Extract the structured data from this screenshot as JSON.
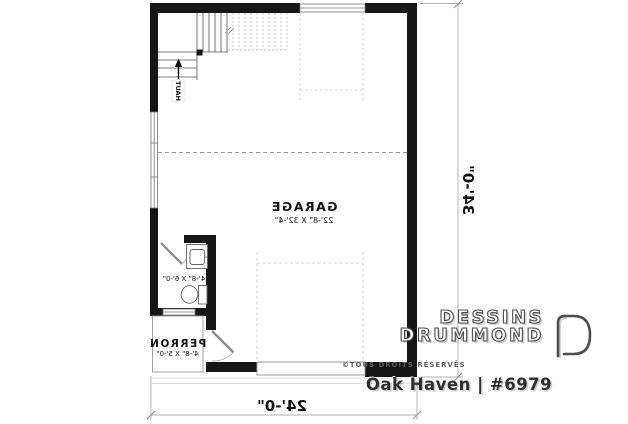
{
  "plan": {
    "rooms": {
      "garage": {
        "name": "GARAGE",
        "dims": "22'-8\" X 32'-4\""
      },
      "bathroom": {
        "dims": "4'-8\" X 6'-0\""
      },
      "perron": {
        "name": "PERRON",
        "dims": "4'-8\" X 5'-0\""
      }
    },
    "labels": {
      "stairs_direction": "HAUT"
    },
    "overall_dimensions": {
      "width": "24'-0\"",
      "height": "34'-0\""
    }
  },
  "branding": {
    "brand_line1": "DESSINS",
    "brand_line2": "DRUMMOND",
    "rights": "©TOUS DROITS RÉSERVÉS",
    "plan_title": "Oak Haven | #6979"
  },
  "colors": {
    "wall": "#161616",
    "line_medium": "#555555",
    "line_light": "#c9c9c9",
    "dimension": "#a9a9a9",
    "brand_outline": "#4c4c4c"
  }
}
